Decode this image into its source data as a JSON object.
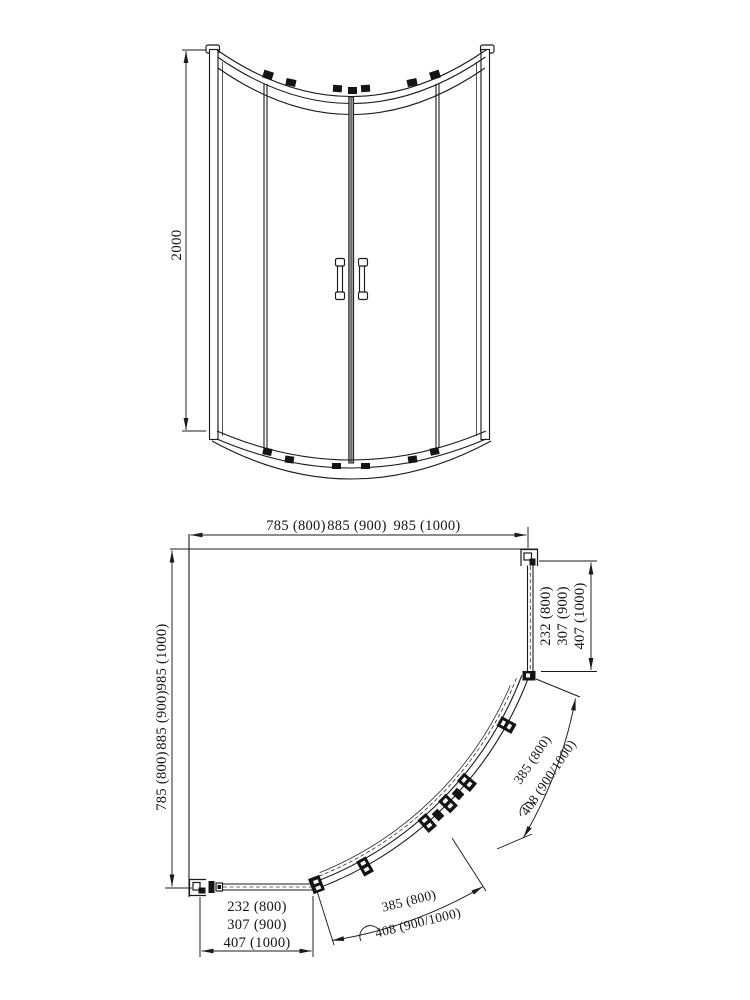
{
  "document": {
    "type": "technical-dimension-drawing",
    "product": "quadrant sliding-door shower enclosure",
    "colors": {
      "line": "#1b1b1b",
      "background": "#ffffff"
    },
    "front_view": {
      "height_dim": "2000"
    },
    "plan_view": {
      "width_dims": [
        "785 (800)",
        "885 (900)",
        "985 (1000)"
      ],
      "depth_dims": [
        "785 (800)",
        "885 (900)",
        "985 (1000)"
      ],
      "side_panel_dims": [
        "232 (800)",
        "307 (900)",
        "407 (1000)"
      ],
      "front_panel_dims": [
        "232 (800)",
        "307 (900)",
        "407 (1000)"
      ],
      "door_arc_right_dims": [
        "385 (800)",
        "408 (900/1000)"
      ],
      "door_arc_bottom_dims": [
        "385 (800)",
        "408 (900/1000)"
      ]
    }
  }
}
